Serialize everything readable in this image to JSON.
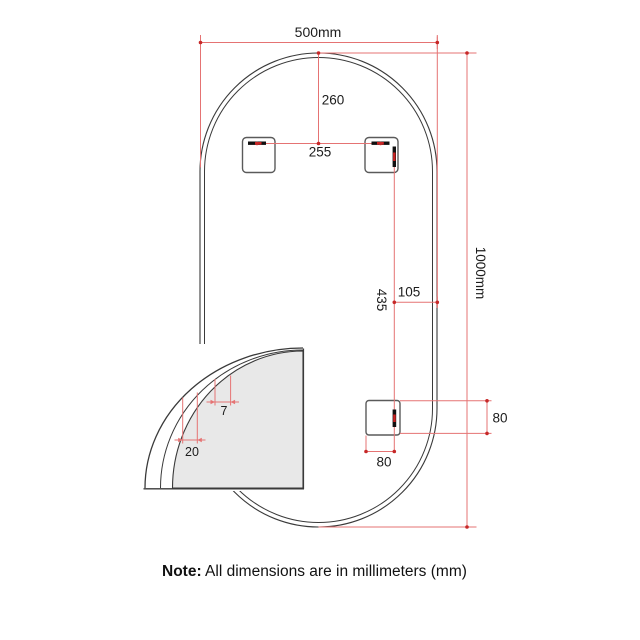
{
  "dimensions": {
    "width": "500mm",
    "height": "1000mm",
    "top_to_bracket_slots": "260",
    "bracket_slot_spacing": "255",
    "top_to_bottom_bracket": "435",
    "bottom_bracket_to_edge": "105",
    "bottom_bracket_height": "80",
    "bottom_bracket_width": "80",
    "detail_bevel_width": "7",
    "detail_frame_width": "20"
  },
  "note": {
    "label": "Note:",
    "text": " All dimensions are in millimeters (mm)"
  },
  "colors": {
    "dimension_line": "#e57373",
    "dimension_marker": "#c62828",
    "outline": "#3a3a3a",
    "bracket_outline": "#5a5a5a",
    "slot": "#111111",
    "detail_fill": "#e8e8e8",
    "background": "#ffffff"
  }
}
